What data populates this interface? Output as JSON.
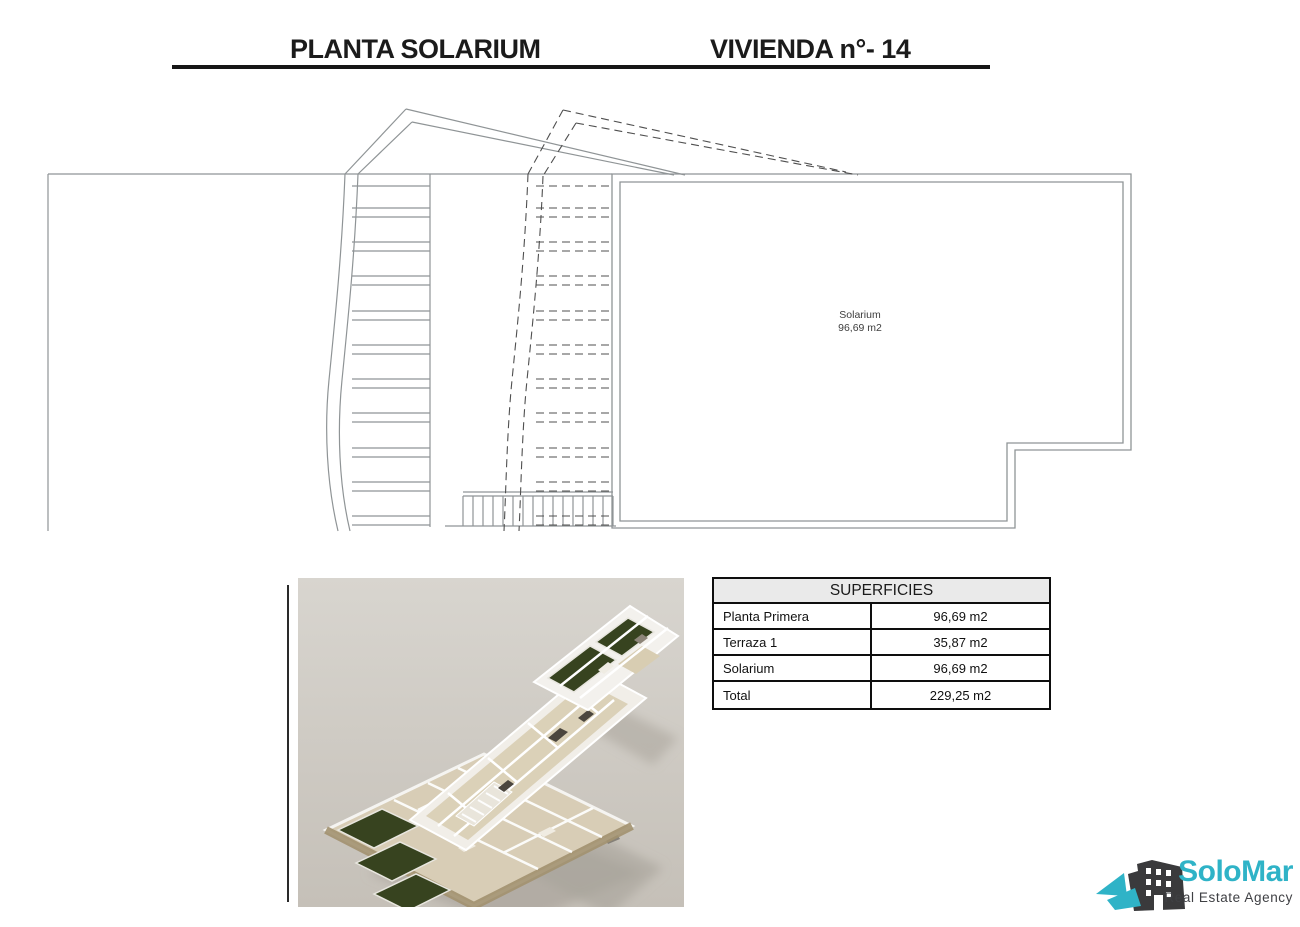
{
  "header": {
    "title_left": "PLANTA SOLARIUM",
    "title_right": "VIVIENDA n°- 14"
  },
  "plan": {
    "room_label": "Solarium",
    "room_area": "96,69 m2"
  },
  "table": {
    "title": "SUPERFICIES",
    "rows": [
      {
        "label": "Planta Primera",
        "value": "96,69 m2"
      },
      {
        "label": "Terraza 1",
        "value": "35,87 m2"
      },
      {
        "label": "Solarium",
        "value": "96,69 m2"
      },
      {
        "label": "Total",
        "value": "229,25 m2"
      }
    ]
  },
  "logo": {
    "brand": "SoloMar",
    "tagline": "Real Estate Agency"
  },
  "colors": {
    "accent_teal": "#2fb3c7",
    "logo_dark": "#3a3a3c",
    "plan_line_gray": "#8f9496",
    "plan_dash_gray": "#4f4f4f",
    "table_header_bg": "#eaeaea",
    "render_background": "#cdc8c0",
    "garden_green": "#37431f"
  }
}
